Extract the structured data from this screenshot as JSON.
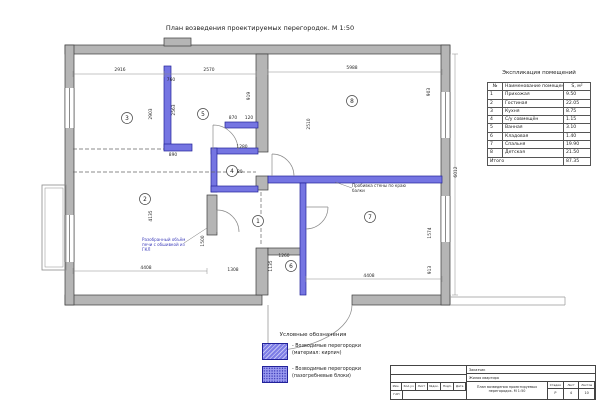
{
  "title": "План возведения проектируемых перегородок. М 1:50",
  "explication": {
    "title": "Экспликация помещений",
    "headers": [
      "№",
      "Наименование помещения",
      "S, м²"
    ],
    "rows": [
      {
        "num": "1",
        "name": "Прихожая",
        "area": "9.50"
      },
      {
        "num": "2",
        "name": "Гостиная",
        "area": "22.05"
      },
      {
        "num": "3",
        "name": "Кухня",
        "area": "8.75"
      },
      {
        "num": "4",
        "name": "С/у совмещён",
        "area": "1.15"
      },
      {
        "num": "5",
        "name": "Ванная",
        "area": "3.10"
      },
      {
        "num": "6",
        "name": "Кладовая",
        "area": "1.40"
      },
      {
        "num": "7",
        "name": "Спальня",
        "area": "19.90"
      },
      {
        "num": "8",
        "name": "Детская",
        "area": "21.50"
      }
    ],
    "total_label": "Итого",
    "total_value": "87.35"
  },
  "legend": {
    "title": "Условные обозначения",
    "items": [
      {
        "swatch": "brick",
        "line1": "- Возводимые перегородки",
        "line2": "(материал: кирпич)"
      },
      {
        "swatch": "blocks",
        "line1": "- Возводимые перегородки",
        "line2": "(пазогребневые блоки)"
      }
    ]
  },
  "stamp": {
    "customer_label": "Заказчик",
    "object_name": "Жилая квартира",
    "header_cells": [
      "Изм.",
      "Кол.уч",
      "Лист",
      "№док.",
      "Подп.",
      "Дата"
    ],
    "gap_label": "ГАП",
    "sheet_title": "План возведения проектируемых перегородок. М 1:50",
    "stage_label": "Стадия",
    "sheet_label": "Лист",
    "sheets_label": "Листов",
    "stage_value": "Р",
    "sheet_value": "4",
    "sheets_value": "10"
  },
  "plan": {
    "accent_partition_color": "#7575e2",
    "wall_color": "#b5b5b5",
    "rooms": [
      {
        "num": "1",
        "x": 258,
        "y": 221
      },
      {
        "num": "2",
        "x": 145,
        "y": 199
      },
      {
        "num": "3",
        "x": 127,
        "y": 118
      },
      {
        "num": "4",
        "x": 232,
        "y": 171
      },
      {
        "num": "5",
        "x": 203,
        "y": 114
      },
      {
        "num": "6",
        "x": 291,
        "y": 266
      },
      {
        "num": "7",
        "x": 370,
        "y": 217
      },
      {
        "num": "8",
        "x": 352,
        "y": 101
      }
    ],
    "dimensions": [
      {
        "t": "2916",
        "x": 120,
        "y": 71
      },
      {
        "t": "2570",
        "x": 209,
        "y": 71
      },
      {
        "t": "5988",
        "x": 352,
        "y": 69
      },
      {
        "t": "760",
        "x": 171,
        "y": 81
      },
      {
        "t": "2563",
        "x": 175,
        "y": 110,
        "v": 1
      },
      {
        "t": "2903",
        "x": 152,
        "y": 114,
        "v": 1
      },
      {
        "t": "919",
        "x": 250,
        "y": 96,
        "v": 1
      },
      {
        "t": "890",
        "x": 173,
        "y": 156
      },
      {
        "t": "1280",
        "x": 242,
        "y": 148
      },
      {
        "t": "870",
        "x": 233,
        "y": 119
      },
      {
        "t": "120",
        "x": 249,
        "y": 119
      },
      {
        "t": "1280",
        "x": 237,
        "y": 173
      },
      {
        "t": "2510",
        "x": 310,
        "y": 124,
        "v": 1
      },
      {
        "t": "903",
        "x": 430,
        "y": 92,
        "v": 1
      },
      {
        "t": "1574",
        "x": 431,
        "y": 233,
        "v": 1
      },
      {
        "t": "913",
        "x": 431,
        "y": 270,
        "v": 1
      },
      {
        "t": "1260",
        "x": 284,
        "y": 257
      },
      {
        "t": "1135",
        "x": 272,
        "y": 266,
        "v": 1
      },
      {
        "t": "4135",
        "x": 152,
        "y": 216,
        "v": 1
      },
      {
        "t": "1500",
        "x": 204,
        "y": 241,
        "v": 1
      },
      {
        "t": "4408",
        "x": 146,
        "y": 269
      },
      {
        "t": "1308",
        "x": 233,
        "y": 271
      },
      {
        "t": "4408",
        "x": 369,
        "y": 277
      },
      {
        "t": "6012",
        "x": 457,
        "y": 172,
        "v": 1
      }
    ],
    "notes": [
      {
        "cls": "note",
        "x": 352,
        "y": 187,
        "lines": [
          "Пробивка стены по краю",
          "балки"
        ]
      },
      {
        "cls": "note note-blue",
        "x": 142,
        "y": 241,
        "lines": [
          "Разобранный объём",
          "печи с обшивкой из",
          "ГКЛ"
        ]
      }
    ]
  }
}
